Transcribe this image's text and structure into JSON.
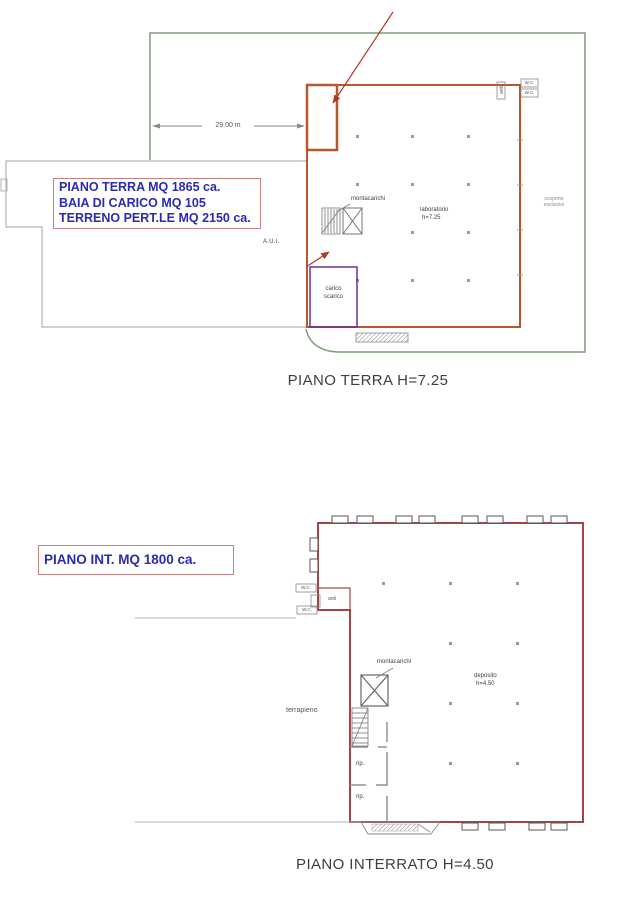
{
  "sheet": {
    "description": "two architectural floor plans, ground floor and basement"
  },
  "colors": {
    "boundary_green": "#7d9c78",
    "building_orange": "#b5582c",
    "arrow_red": "#b03a25",
    "loading_purple": "#6b2f9e",
    "basement_red": "#a34545",
    "annotation_blue": "#2b2bb0",
    "box_border_pink": "#c98080",
    "caption_gray": "#3f3f3f"
  },
  "ground_floor": {
    "caption": "PIANO TERRA H=7.25",
    "area_box": [
      "PIANO TERRA MQ 1865 ca.",
      "BAIA DI CARICO MQ 105",
      "TERRENO PERT.LE MQ 2150 ca."
    ],
    "dimension_label": "29.00 m",
    "labels": {
      "montacarichi": "montacarichi",
      "laboratorio_line1": "laboratorio",
      "laboratorio_line2": "h=7.25",
      "carico_line1": "carico",
      "carico_line2": "scarico",
      "aui": "A.U.I.",
      "scoperto_line1": "scoperto",
      "scoperto_line2": "esclusivo",
      "wc": "W.C.",
      "anti": "anti"
    }
  },
  "basement": {
    "caption": "PIANO INTERRATO H=4.50",
    "area_box": [
      "PIANO INT. MQ 1800 ca."
    ],
    "labels": {
      "montacarichi": "montacarichi",
      "deposito_line1": "deposito",
      "deposito_line2": "h=4.50",
      "terrapieno": "terrapieno",
      "rip": "rip.",
      "wc": "W.C.",
      "anti": "anti"
    }
  }
}
